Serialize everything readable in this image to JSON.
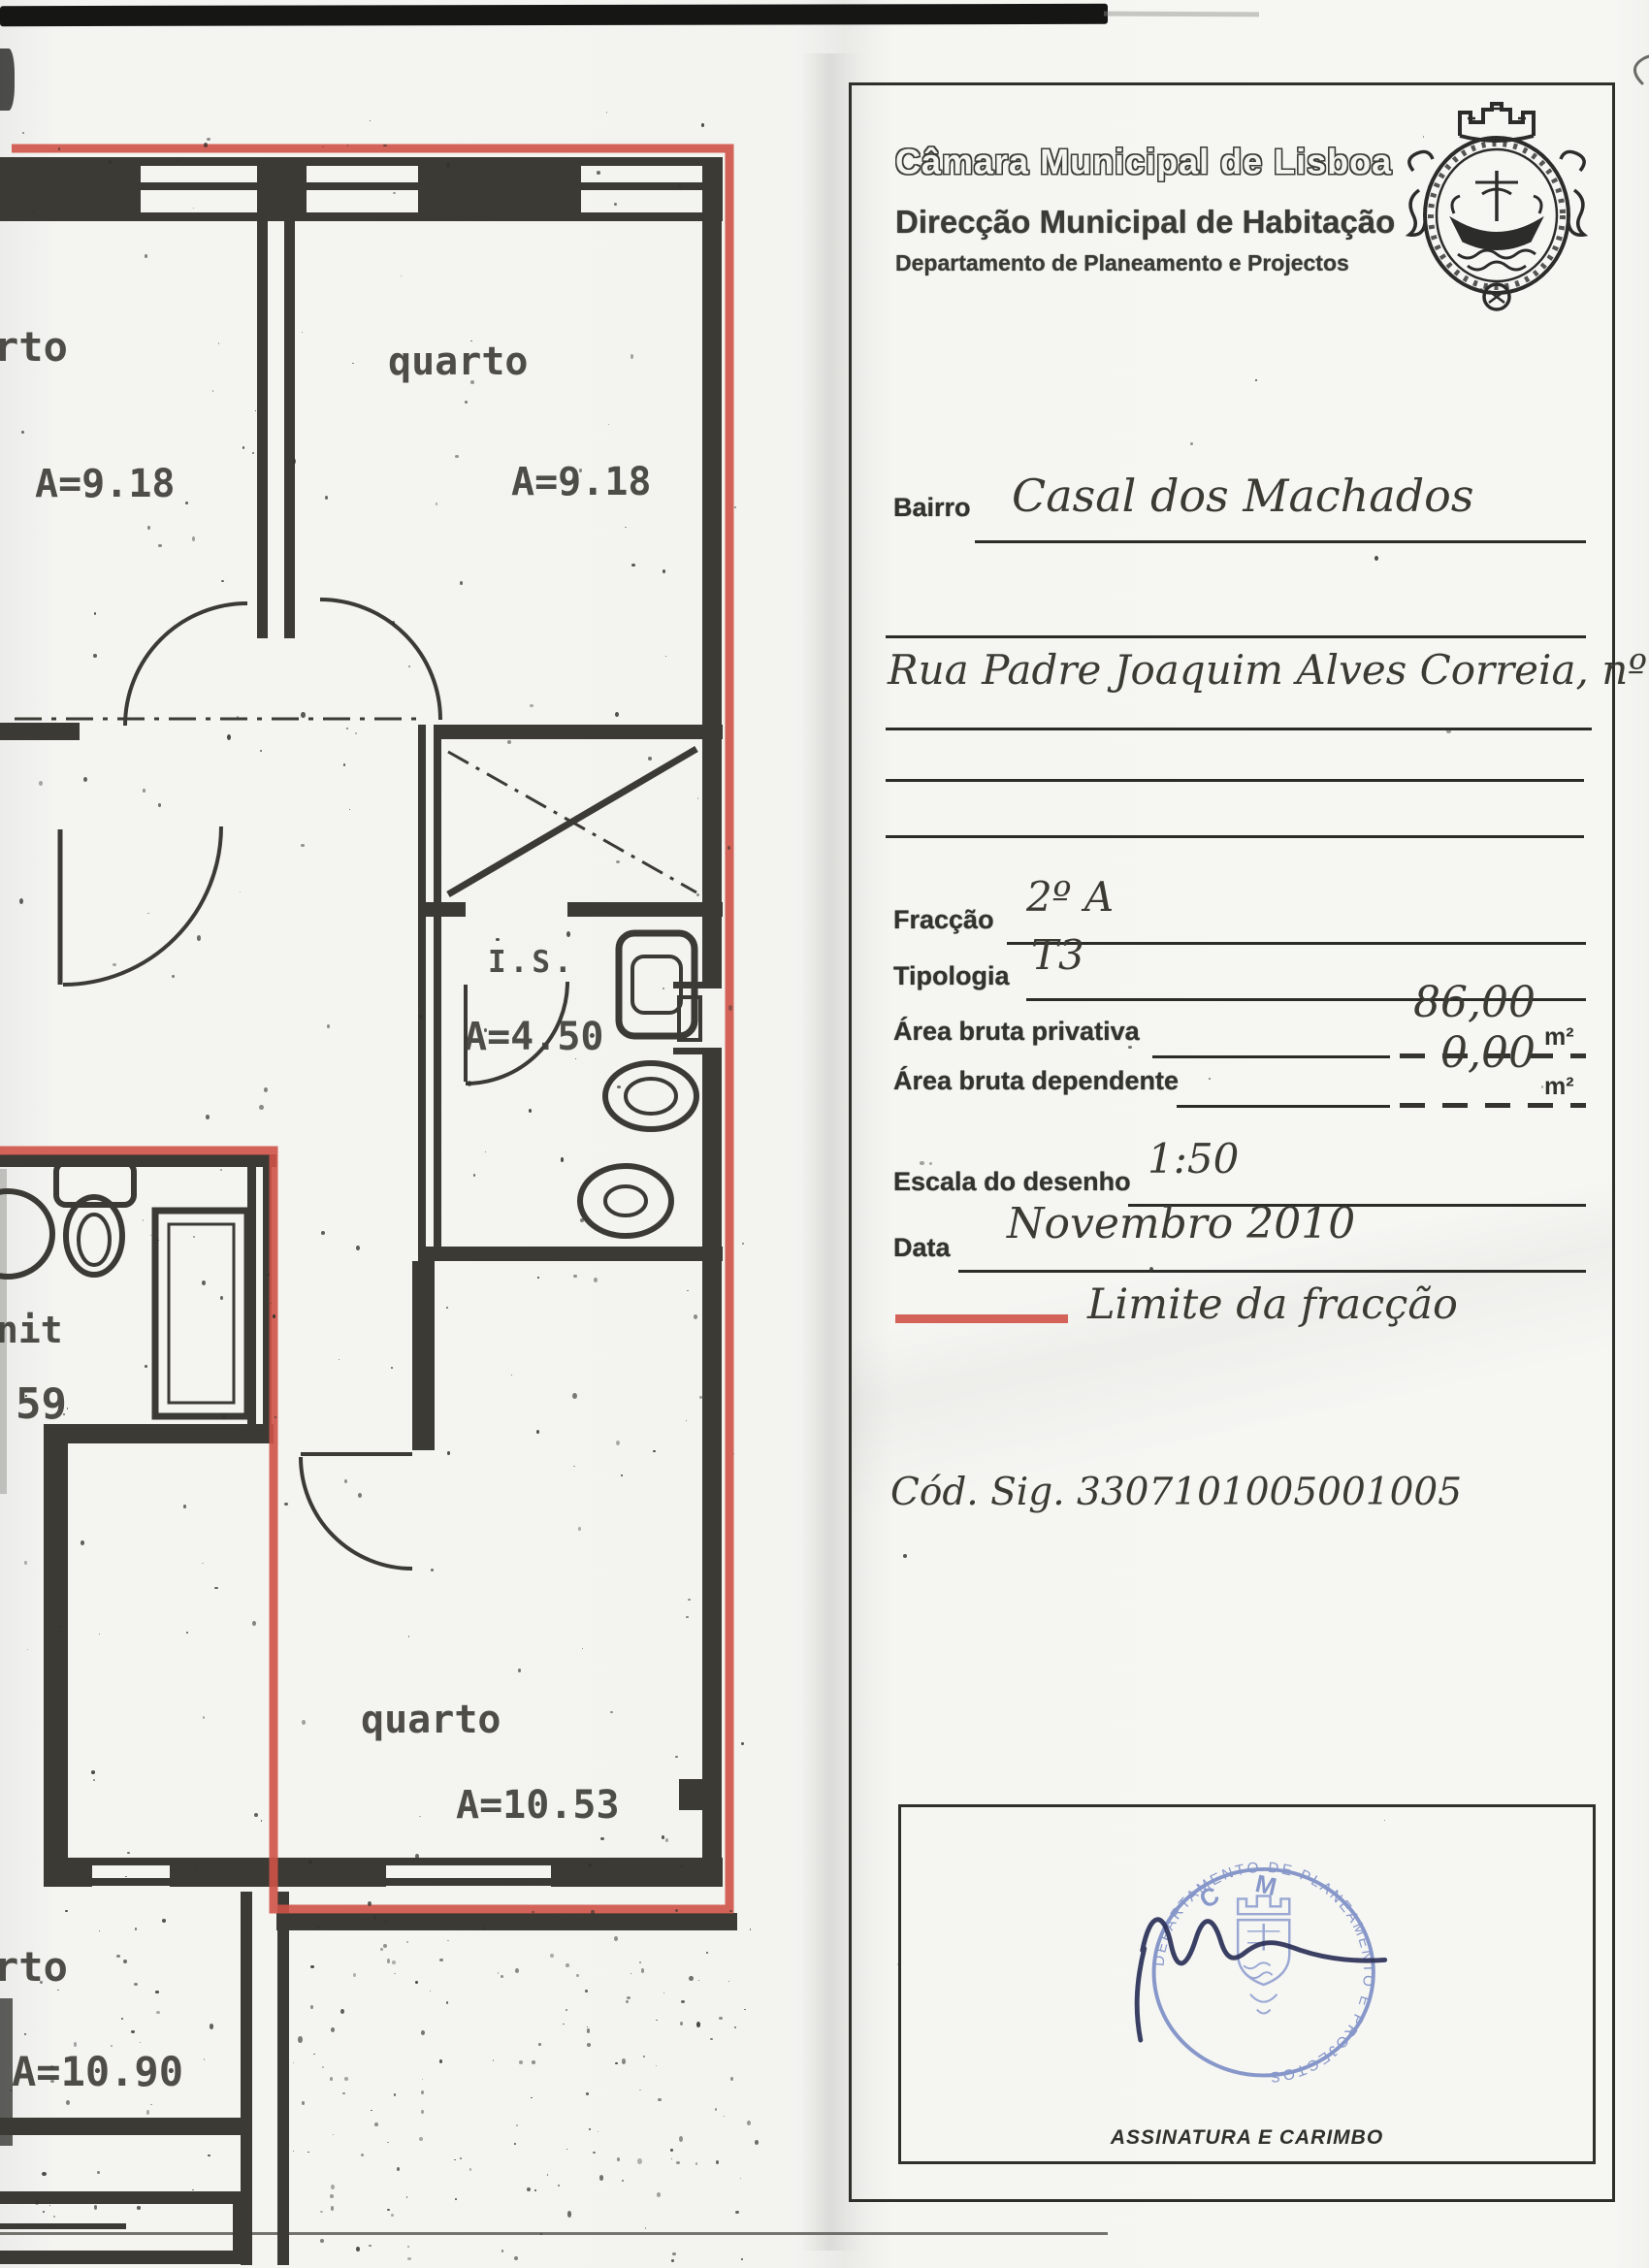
{
  "panel": {
    "org": "Câmara Municipal de Lisboa",
    "dept": "Direcção Municipal de Habitação",
    "subdept": "Departamento de Planeamento e Projectos",
    "fields": {
      "bairro": {
        "label": "Bairro",
        "value": "Casal dos Machados"
      },
      "rua": {
        "value": "Rua Padre Joaquim Alves Correia, nº 6"
      },
      "fraccao": {
        "label": "Fracção",
        "value": "2º A"
      },
      "tipologia": {
        "label": "Tipologia",
        "value": "T3"
      },
      "area_privativa": {
        "label": "Área bruta privativa",
        "value": "86,00",
        "unit": "m²"
      },
      "area_dependente": {
        "label": "Área bruta dependente",
        "value": "0,00",
        "unit": "m²"
      },
      "escala": {
        "label": "Escala do desenho",
        "value": "1:50"
      },
      "data": {
        "label": "Data",
        "value": "Novembro 2010"
      }
    },
    "legend": {
      "label": "Limite da fracção"
    },
    "cod_sig": "Cód. Sig. 3307101005001005",
    "signature": {
      "caption": "ASSINATURA E CARIMBO",
      "stamp_top": "C M L",
      "stamp_ring": "DEPARTAMENTO DE PLANEAMENTO E PROJECTOS"
    }
  },
  "plan": {
    "room_top_left": {
      "label": "rto",
      "area": "A=9.18"
    },
    "room_top": {
      "label": "quarto",
      "area": "A=9.18"
    },
    "bath": {
      "label": "I.S.",
      "area": "A=4.50"
    },
    "left_partial": {
      "label": "nit",
      "area": "59"
    },
    "room_bottom": {
      "label": "quarto",
      "area": "A=10.53"
    },
    "room_other": {
      "label": "rto",
      "area": "A=10.90"
    }
  },
  "colors": {
    "boundary": "#cf5348",
    "stamp": "#7487c2",
    "signature": "#2b3158"
  }
}
